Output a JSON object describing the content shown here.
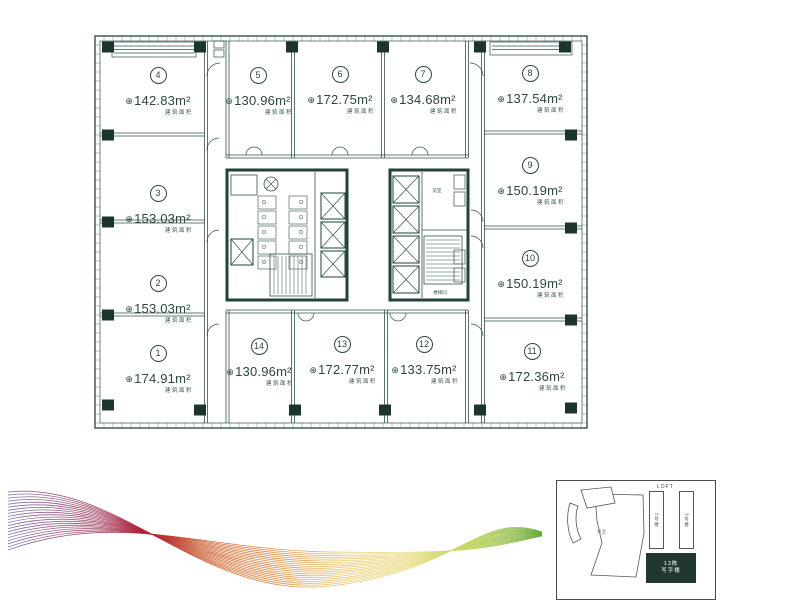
{
  "colors": {
    "ink": "#33524a",
    "ink_dark": "#22423a",
    "column": "#1b352d",
    "paper": "#ffffff",
    "keyplan_highlight": "#20382f",
    "wave": [
      "#6e5f9b",
      "#8f3a62",
      "#b02038",
      "#c8541f",
      "#d97b28",
      "#e7c15a",
      "#e9e08b",
      "#bfd35e",
      "#63a839"
    ]
  },
  "icons": {
    "area_mark": "⊕"
  },
  "units": [
    {
      "no": "1",
      "area": "174.91m²",
      "caption": "建筑面积"
    },
    {
      "no": "2",
      "area": "153.03m²",
      "caption": "建筑面积"
    },
    {
      "no": "3",
      "area": "153.03m²",
      "caption": "建筑面积"
    },
    {
      "no": "4",
      "area": "142.83m²",
      "caption": "建筑面积"
    },
    {
      "no": "5",
      "area": "130.96m²",
      "caption": "建筑面积"
    },
    {
      "no": "6",
      "area": "172.75m²",
      "caption": "建筑面积"
    },
    {
      "no": "7",
      "area": "134.68m²",
      "caption": "建筑面积"
    },
    {
      "no": "8",
      "area": "137.54m²",
      "caption": "建筑面积"
    },
    {
      "no": "9",
      "area": "150.19m²",
      "caption": "建筑面积"
    },
    {
      "no": "10",
      "area": "150.19m²",
      "caption": "建筑面积"
    },
    {
      "no": "11",
      "area": "172.36m²",
      "caption": "建筑面积"
    },
    {
      "no": "12",
      "area": "133.75m²",
      "caption": "建筑面积"
    },
    {
      "no": "13",
      "area": "172.77m²",
      "caption": "建筑面积"
    },
    {
      "no": "14",
      "area": "130.96m²",
      "caption": "建筑面积"
    }
  ],
  "core": {
    "front_room": "前室",
    "stairwell": "楼梯间"
  },
  "keyplan": {
    "loft": "LOFT",
    "tower_left": "2号楼",
    "tower_right": "3号楼",
    "podium": "商业",
    "highlight_line1": "13栋",
    "highlight_line2": "写字楼"
  }
}
